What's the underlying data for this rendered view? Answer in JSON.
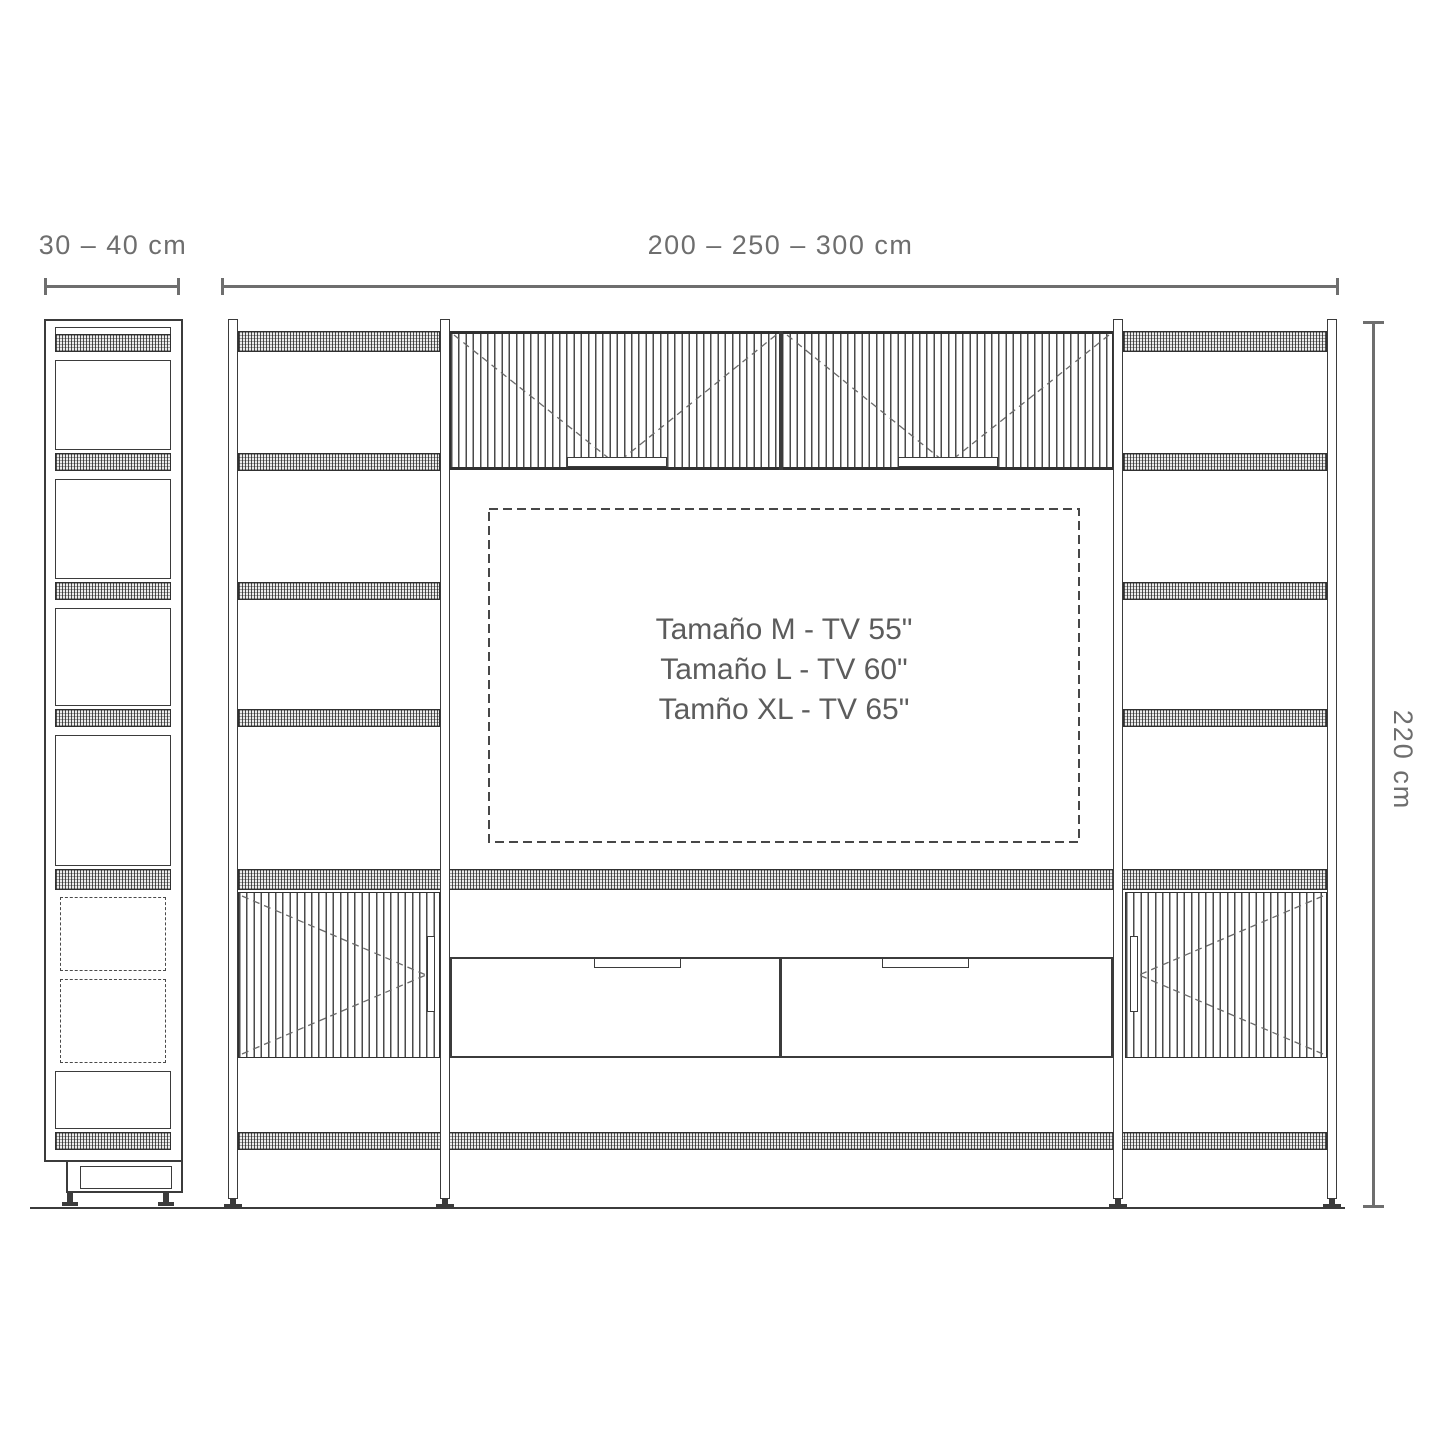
{
  "annotations": {
    "side_width": "30 – 40 cm",
    "front_width": "200 – 250 – 300 cm",
    "height": "220 cm"
  },
  "tv_size_labels": [
    "Tamaño M - TV 55\"",
    "Tamaño L - TV 60\"",
    "Tamño XL - TV 65\""
  ],
  "colors": {
    "line": "#3b3b3b",
    "dimension": "#6e6e6e",
    "label": "#5c5c5c"
  }
}
